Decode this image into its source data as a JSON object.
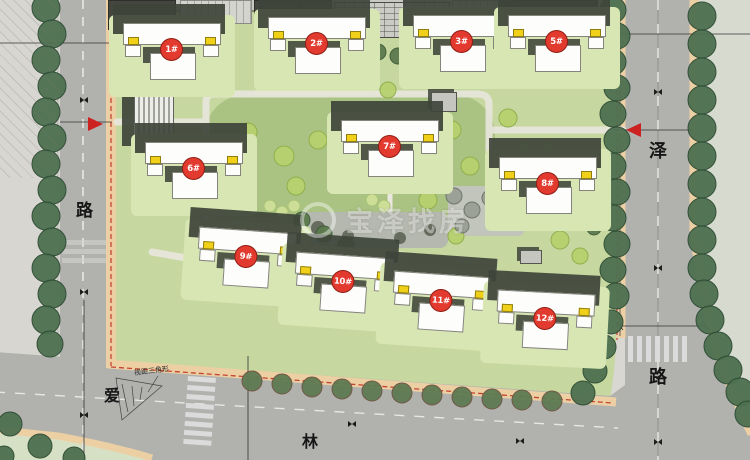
{
  "watermark": {
    "brand": "宝泽找房"
  },
  "roads": {
    "left_label": "路",
    "right_label_top": "泽",
    "right_label_bottom": "路",
    "bottom_label_left": "爱",
    "bottom_label_right": "林"
  },
  "labels": {
    "sight_triangle": "视距三角形"
  },
  "buildings": [
    {
      "label": "1#"
    },
    {
      "label": "2#"
    },
    {
      "label": "3#"
    },
    {
      "label": "5#"
    },
    {
      "label": "6#"
    },
    {
      "label": "7#"
    },
    {
      "label": "8#"
    },
    {
      "label": "9#"
    },
    {
      "label": "10#"
    },
    {
      "label": "11#"
    },
    {
      "label": "12#"
    }
  ],
  "colors": {
    "road": "#b1b1ae",
    "site_green": "#c6d79f",
    "sidewalk": "#ecd0a4",
    "tree_dark": "#4d7050",
    "tree_light": "#b7d16f",
    "building_marker": "#e23a2e",
    "unit_badge": "#f0d019",
    "boundary_red": "#c44433"
  }
}
